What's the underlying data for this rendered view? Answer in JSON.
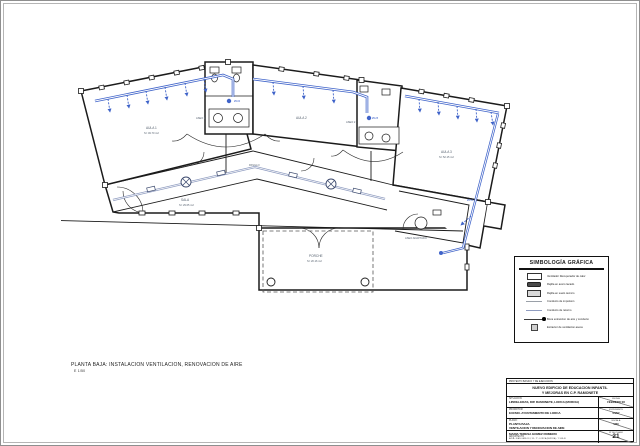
{
  "sheet": {
    "caption_line1": "PLANTA BAJA: INSTALACION VENTILACION, RENOVACION DE AIRE",
    "caption_line2": "E 1/50"
  },
  "legend": {
    "title": "SIMBOLOGÍA GRÁFICA",
    "items": [
      {
        "symbol": "recuperator-box",
        "label": "Ventilador Recuperador de calor"
      },
      {
        "symbol": "grille-dark",
        "label": "Rejilla en acero lacado"
      },
      {
        "symbol": "grille-light",
        "label": "Rejilla en suelo tecnico"
      },
      {
        "symbol": "line-supply",
        "label": "Conducto de impulsion"
      },
      {
        "symbol": "line-return",
        "label": "Conducto de retorno"
      },
      {
        "symbol": "line-extract",
        "label": "Boca extraccion de aire y conducto"
      },
      {
        "symbol": "extractor-box",
        "label": "Extractor de ventilacion aseos"
      }
    ]
  },
  "title_block": {
    "header": "PROYECTO BASICO Y DE EJECUCION",
    "project_title_1": "NUEVO EDIFICIO DE EDUCACION INFANTIL",
    "project_title_2": "Y MEJORAS EN C.P. RAMONETE",
    "situacion_label": "SITUACION:",
    "situacion": "LIBRILLERAS, DIP. RAMONETE, LORCA (MURCIA)",
    "promotor_label": "PROMOTOR:",
    "promotor": "EXCMO. AYUNTAMIENTO DE LORCA",
    "plano_label": "PLANO:",
    "plano_1": "PLANTA BAJA.",
    "plano_2": "VENTILACION Y RENOVACION DE AIRE",
    "arquitecto": "MARIA TERESA GOMEZ ROMERO",
    "arquitecto_label": "ARQUITECTO",
    "address": "AVDA. JUAN CARLOS I, 33 - 1º - LORCA (MURCIA) - T. 968 46",
    "fecha_label": "FECHA",
    "fecha": "FEBRERO 08",
    "expediente_label": "EXPEDIENTE",
    "expediente": "04/07",
    "escala_label": "ESCALA",
    "escala": "1/50",
    "plano_num_label": "Nº DE PLANO",
    "plano_num": "21"
  },
  "plan": {
    "colors": {
      "duct_blue": "#3f63c9",
      "wall": "#1b1b1b",
      "corridor_duct": "#8f9cc0"
    },
    "labels": {
      "aula1": "AULA 1",
      "aula1_area": "S= 49.70 m2",
      "aseo1": "ASEO 1",
      "aula2": "AULA 2",
      "aseo2": "ASEO 2",
      "aula3": "AULA 3",
      "aula3_area": "S= 52.15 m2",
      "pasillo": "PASILLO",
      "sala": "SALA",
      "sala_area": "S= 29.05 m2",
      "porche": "PORCHE",
      "porche_area": "S= 20.16 m2",
      "aseo_adaptado": "ASEO ADAPTADO",
      "duct_note1": "Ø125",
      "duct_note2": "Ø100",
      "duct_note3": "Ø150"
    }
  }
}
